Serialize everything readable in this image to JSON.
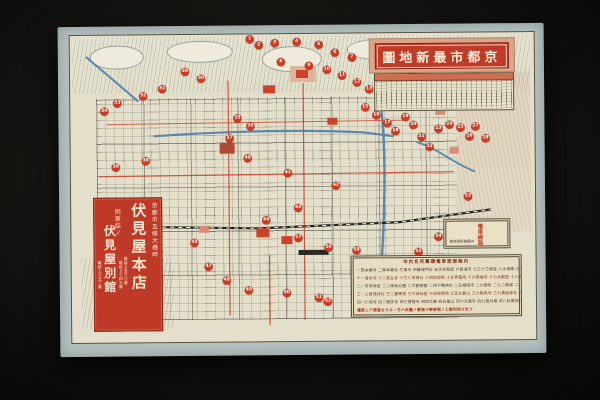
{
  "photo": {
    "backdrop_color": "#141412",
    "paper_margin_color": "#b7c2c2",
    "map_paper_color": "#e3dfca",
    "accent_red": "#c03a28",
    "marker_red": "#ce3b20",
    "water_blue": "#5b86ad"
  },
  "title_banner": {
    "text_displayed_rtl": "圖地新最市都京",
    "text_reading": "京都市最新地圖"
  },
  "shop_banner": {
    "address_honten": "京都市五條大橋畔",
    "honten_name": "伏見屋本店",
    "phones_honten": [
      "電話上五三六番",
      "電話上七四九番"
    ],
    "address_bekkan": "同東詰ノ",
    "bekkan_name": "伏見屋別館",
    "phone_bekkan": "電話上七五二番"
  },
  "legend_box": {
    "title": "市内名所舊蹟電車筋御案内",
    "rows": [
      "一西本願寺 二東本願寺 三東寺 四羅城門址 五伏見稻荷 六泉涌寺 七三十三間堂 八大佛殿 九豐國神社 十耳塚",
      "十一清水寺 十二高台寺 十三八坂神社 十四知恩院 十五青蓮院 十六南禪寺 十七永觀堂 十八銀閣寺 十九黑谷 二十吉田神社",
      "二一平安神宮 二二岡崎公園 二三動物園 二四下鴨神社 二五相國寺 二六御所 二七二條城 二八北野神社 二九金閣寺 三十大德寺",
      "三一上賀茂神社 三二曼殊院 三三詩仙堂 三四修學院 三五比叡山 三六鞍馬寺 三七貴船神社 三八大原 三九寂光院 四十妙心寺",
      "四一仁和寺 四二龍安寺 四三廣隆寺 四四太秦 四五嵐山 四六天龍寺 四七渡月橋 四八松尾神社 四九桂離宮 五十東福寺",
      "電車ニテ周遊セラルヽ方ハ本圖ノ番號ヲ御參照ノ上御利用ヲ乞フ"
    ]
  },
  "key_box": {
    "label": "電車線路",
    "note": "乘換場所御案内"
  },
  "map": {
    "markers": [
      {
        "x": 192,
        "y": 14,
        "n": "1"
      },
      {
        "x": 201,
        "y": 20,
        "n": "2"
      },
      {
        "x": 217,
        "y": 18,
        "n": "3"
      },
      {
        "x": 239,
        "y": 17,
        "n": "4"
      },
      {
        "x": 261,
        "y": 20,
        "n": "5"
      },
      {
        "x": 277,
        "y": 28,
        "n": "6"
      },
      {
        "x": 294,
        "y": 33,
        "n": "7"
      },
      {
        "x": 223,
        "y": 37,
        "n": "8"
      },
      {
        "x": 251,
        "y": 41,
        "n": "9"
      },
      {
        "x": 269,
        "y": 45,
        "n": "10"
      },
      {
        "x": 284,
        "y": 51,
        "n": "11"
      },
      {
        "x": 299,
        "y": 58,
        "n": "12"
      },
      {
        "x": 311,
        "y": 65,
        "n": "13"
      },
      {
        "x": 324,
        "y": 73,
        "n": "14"
      },
      {
        "x": 307,
        "y": 83,
        "n": "15"
      },
      {
        "x": 318,
        "y": 91,
        "n": "16"
      },
      {
        "x": 329,
        "y": 99,
        "n": "17"
      },
      {
        "x": 337,
        "y": 107,
        "n": "18"
      },
      {
        "x": 347,
        "y": 93,
        "n": "19"
      },
      {
        "x": 355,
        "y": 101,
        "n": "20"
      },
      {
        "x": 363,
        "y": 113,
        "n": "21"
      },
      {
        "x": 371,
        "y": 123,
        "n": "22"
      },
      {
        "x": 380,
        "y": 105,
        "n": "23"
      },
      {
        "x": 391,
        "y": 101,
        "n": "24"
      },
      {
        "x": 402,
        "y": 104,
        "n": "25"
      },
      {
        "x": 411,
        "y": 113,
        "n": "26"
      },
      {
        "x": 417,
        "y": 103,
        "n": "27"
      },
      {
        "x": 427,
        "y": 115,
        "n": "28"
      },
      {
        "x": 127,
        "y": 46,
        "n": "29"
      },
      {
        "x": 143,
        "y": 53,
        "n": "30"
      },
      {
        "x": 104,
        "y": 63,
        "n": "31"
      },
      {
        "x": 85,
        "y": 70,
        "n": "32"
      },
      {
        "x": 59,
        "y": 77,
        "n": "33"
      },
      {
        "x": 46,
        "y": 85,
        "n": "34"
      },
      {
        "x": 179,
        "y": 93,
        "n": "35"
      },
      {
        "x": 192,
        "y": 101,
        "n": "36"
      },
      {
        "x": 171,
        "y": 113,
        "n": "37"
      },
      {
        "x": 87,
        "y": 135,
        "n": "38"
      },
      {
        "x": 57,
        "y": 141,
        "n": "39"
      },
      {
        "x": 189,
        "y": 133,
        "n": "40"
      },
      {
        "x": 229,
        "y": 148,
        "n": "41"
      },
      {
        "x": 277,
        "y": 161,
        "n": "42"
      },
      {
        "x": 239,
        "y": 183,
        "n": "43"
      },
      {
        "x": 207,
        "y": 195,
        "n": "44"
      },
      {
        "x": 135,
        "y": 217,
        "n": "45"
      },
      {
        "x": 99,
        "y": 225,
        "n": "46"
      },
      {
        "x": 149,
        "y": 241,
        "n": "47"
      },
      {
        "x": 167,
        "y": 255,
        "n": "48"
      },
      {
        "x": 189,
        "y": 265,
        "n": "49"
      },
      {
        "x": 227,
        "y": 268,
        "n": "50"
      },
      {
        "x": 259,
        "y": 273,
        "n": "51"
      },
      {
        "x": 268,
        "y": 277,
        "n": "52"
      },
      {
        "x": 409,
        "y": 173,
        "n": "53"
      },
      {
        "x": 379,
        "y": 213,
        "n": "54"
      },
      {
        "x": 359,
        "y": 228,
        "n": "55"
      },
      {
        "x": 269,
        "y": 223,
        "n": "56"
      },
      {
        "x": 239,
        "y": 213,
        "n": "57"
      },
      {
        "x": 297,
        "y": 226,
        "n": "58"
      }
    ],
    "blocks": [
      {
        "x": 232,
        "y": 41,
        "w": 26,
        "h": 16,
        "c": "#dfb49c"
      },
      {
        "x": 238,
        "y": 45,
        "w": 12,
        "h": 8,
        "c": "#cc4229"
      },
      {
        "x": 161,
        "y": 117,
        "w": 15,
        "h": 11,
        "c": "#b14a33"
      },
      {
        "x": 197,
        "y": 203,
        "w": 13,
        "h": 9,
        "c": "#cc4229"
      },
      {
        "x": 222,
        "y": 211,
        "w": 11,
        "h": 8,
        "c": "#cc4229"
      },
      {
        "x": 239,
        "y": 225,
        "w": 30,
        "h": 5,
        "c": "#2a2a24"
      },
      {
        "x": 359,
        "y": 61,
        "w": 12,
        "h": 9,
        "c": "#d98d77"
      },
      {
        "x": 377,
        "y": 83,
        "w": 10,
        "h": 8,
        "c": "#d98d77"
      },
      {
        "x": 391,
        "y": 123,
        "w": 9,
        "h": 7,
        "c": "#d98d77"
      },
      {
        "x": 269,
        "y": 93,
        "w": 10,
        "h": 7,
        "c": "#cc4229"
      },
      {
        "x": 205,
        "y": 60,
        "w": 12,
        "h": 8,
        "c": "#cc4229"
      },
      {
        "x": 140,
        "y": 200,
        "w": 10,
        "h": 7,
        "c": "#d98d77"
      }
    ]
  }
}
